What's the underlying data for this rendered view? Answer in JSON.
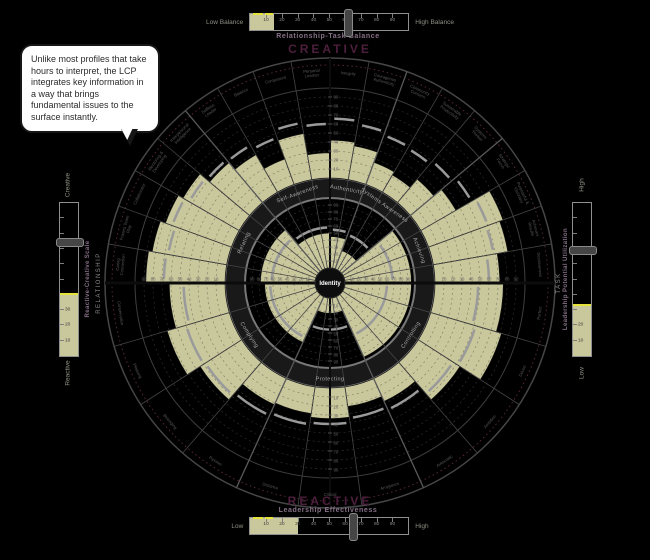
{
  "callout": {
    "text": "Unlike most profiles that take hours to interpret, the LCP integrates key information in a way that brings fundamental issues to the surface instantly."
  },
  "colors": {
    "background": "#000000",
    "olive": "#c9c79c",
    "purple_heading": "#4d1f3d",
    "band_gray": "#787878",
    "marker_gray": "#9a9a9a",
    "yellow": "#e6e23c"
  },
  "gauges": {
    "top": {
      "heading": "CREATIVE",
      "title": "Relationship-Task Balance",
      "min_label": "Low Balance",
      "max_label": "High Balance",
      "ticks": [
        10,
        20,
        30,
        40,
        50,
        60,
        70,
        80,
        90
      ],
      "fill_value": 15,
      "slider_value": 62
    },
    "bottom": {
      "heading": "REACTIVE",
      "title": "Leadership Effectiveness",
      "min_label": "Low",
      "max_label": "High",
      "ticks": [
        10,
        20,
        30,
        40,
        50,
        60,
        70,
        80,
        90
      ],
      "fill_value": 30,
      "slider_value": 65
    },
    "left": {
      "title": "Reactive-Creative Scale",
      "min_label": "Reactive",
      "max_label": "Creative",
      "ticks": [
        10,
        20,
        30
      ],
      "fill_value": 40,
      "slider_from_top": 25
    },
    "right": {
      "title": "Leadership Potential Utilization",
      "min_label": "Low",
      "max_label": "High",
      "ticks": [
        10,
        20
      ],
      "fill_value": 33,
      "slider_from_top": 30
    }
  },
  "chart_data": {
    "type": "radial-profile",
    "title": "Leadership Circle Profile",
    "center_label": "Identity",
    "top_half_label": "CREATIVE",
    "bottom_half_label": "REACTIVE",
    "left_axis_label": "RELATIONSHIP",
    "right_axis_label": "TASK",
    "inner_scale_ticks": [
      10,
      20,
      30,
      40,
      50,
      60,
      70,
      80,
      90
    ],
    "outer_scale_ticks": [
      10,
      20,
      30,
      40,
      50,
      60,
      70,
      80,
      90
    ],
    "inner_dimensions": [
      {
        "name": "Relating",
        "value": 78,
        "marker": 62
      },
      {
        "name": "Self-Awareness",
        "value": 50,
        "marker": 58
      },
      {
        "name": "Authenticity",
        "value": 45,
        "marker": 55
      },
      {
        "name": "Systems Awareness",
        "value": 28,
        "marker": 52
      },
      {
        "name": "Achieving",
        "value": 95,
        "marker": 68
      },
      {
        "name": "Controlling",
        "value": 95,
        "marker": 60
      },
      {
        "name": "Protecting",
        "value": 22,
        "marker": 45
      },
      {
        "name": "Complying",
        "value": 72,
        "marker": 64
      }
    ],
    "outer_competencies": [
      {
        "name": "Caring Connection",
        "group": "Relating",
        "value": 88,
        "marker": 68
      },
      {
        "name": "Fosters Team Play",
        "group": "Relating",
        "value": 84,
        "marker": 66
      },
      {
        "name": "Collaborator",
        "group": "Relating",
        "value": 78,
        "marker": 70
      },
      {
        "name": "Mentoring & Developing",
        "group": "Relating",
        "value": 72,
        "marker": 64
      },
      {
        "name": "Interpersonal Intelligence",
        "group": "Relating",
        "value": 58,
        "marker": 62
      },
      {
        "name": "Selfless Leader",
        "group": "Self-Awareness",
        "value": 48,
        "marker": 60
      },
      {
        "name": "Balance",
        "group": "Self-Awareness",
        "value": 30,
        "marker": 55
      },
      {
        "name": "Composure",
        "group": "Self-Awareness",
        "value": 52,
        "marker": 64
      },
      {
        "name": "Personal Learner",
        "group": "Self-Awareness",
        "value": 28,
        "marker": 60
      },
      {
        "name": "Integrity",
        "group": "Authenticity",
        "value": 42,
        "marker": 66
      },
      {
        "name": "Courageous Authenticity",
        "group": "Authenticity",
        "value": 38,
        "marker": 62
      },
      {
        "name": "Community Concern",
        "group": "Systems Awareness",
        "value": 26,
        "marker": 58
      },
      {
        "name": "Sustainable Productivity",
        "group": "Systems Awareness",
        "value": 22,
        "marker": 56
      },
      {
        "name": "Systems Thinker",
        "group": "Systems Awareness",
        "value": 34,
        "marker": 60
      },
      {
        "name": "Strategic Focus",
        "group": "Achieving",
        "value": 45,
        "marker": 65
      },
      {
        "name": "Purposeful & Visionary",
        "group": "Achieving",
        "value": 88,
        "marker": 70
      },
      {
        "name": "Achieves Results",
        "group": "Achieving",
        "value": 84,
        "marker": 68
      },
      {
        "name": "Decisiveness",
        "group": "Achieving",
        "value": 72,
        "marker": 60
      },
      {
        "name": "Perfect",
        "group": "Controlling",
        "value": 76,
        "marker": 48
      },
      {
        "name": "Driven",
        "group": "Controlling",
        "value": 82,
        "marker": 52
      },
      {
        "name": "Ambition",
        "group": "Controlling",
        "value": 55,
        "marker": 46
      },
      {
        "name": "Autocratic",
        "group": "Controlling",
        "value": 28,
        "marker": 38
      },
      {
        "name": "Arrogance",
        "group": "Protecting",
        "value": 22,
        "marker": 35
      },
      {
        "name": "Critical",
        "group": "Protecting",
        "value": 34,
        "marker": 40
      },
      {
        "name": "Distance",
        "group": "Protecting",
        "value": 30,
        "marker": 42
      },
      {
        "name": "Passive",
        "group": "Complying",
        "value": 32,
        "marker": 45
      },
      {
        "name": "Belonging",
        "group": "Complying",
        "value": 55,
        "marker": 48
      },
      {
        "name": "Pleasing",
        "group": "Complying",
        "value": 72,
        "marker": 50
      },
      {
        "name": "Conservative",
        "group": "Complying",
        "value": 62,
        "marker": 46
      }
    ]
  }
}
